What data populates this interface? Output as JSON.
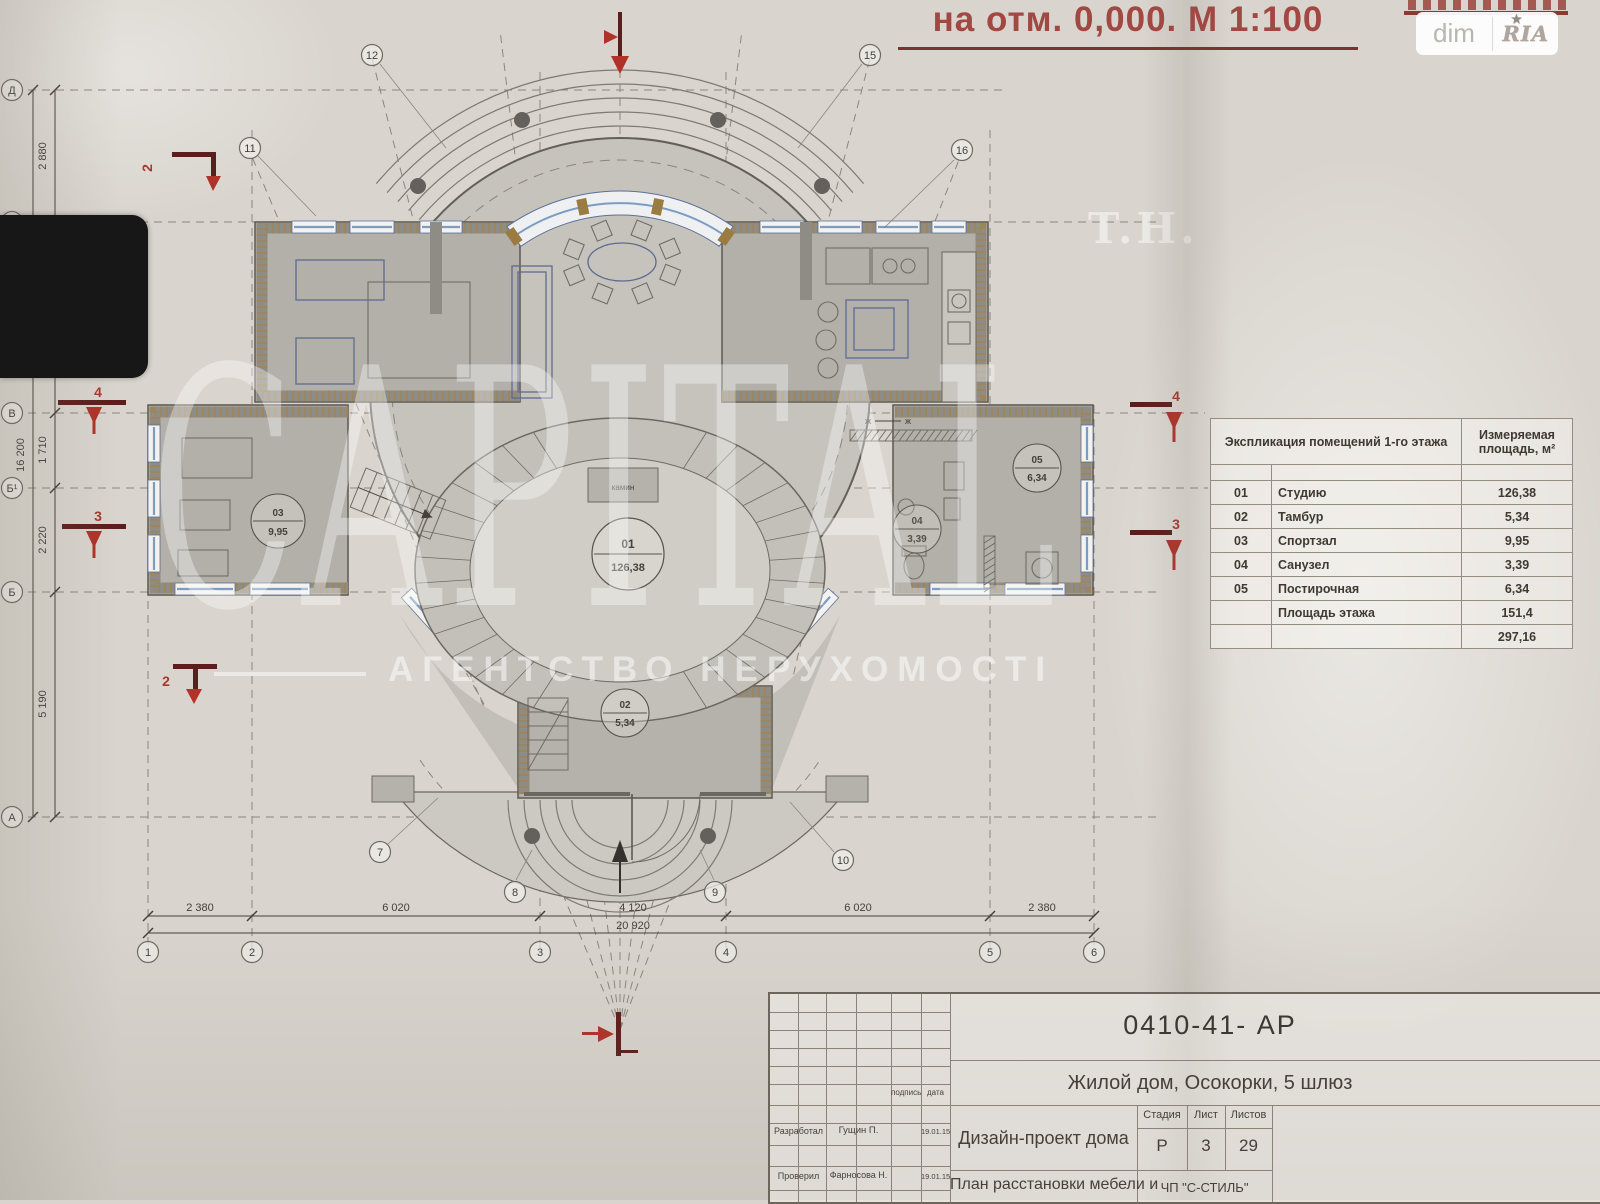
{
  "header": {
    "title": "на отм. 0,000. М 1:100",
    "logo_left": "dim",
    "logo_right": "RIA",
    "logo_star": "★"
  },
  "watermark": {
    "prefix": "T.H.",
    "brand": "CAPITAL",
    "subtitle": "АГЕНТСТВО НЕРУХОМОСТІ"
  },
  "explication": {
    "header_name": "Экспликация помещений 1-го этажа",
    "header_area": "Измеряемая площадь, м²",
    "rows": [
      {
        "num": "01",
        "name": "Студию",
        "area": "126,38"
      },
      {
        "num": "02",
        "name": "Тамбур",
        "area": "5,34"
      },
      {
        "num": "03",
        "name": "Спортзал",
        "area": "9,95"
      },
      {
        "num": "04",
        "name": "Санузел",
        "area": "3,39"
      },
      {
        "num": "05",
        "name": "Постирочная",
        "area": "6,34"
      }
    ],
    "total_label": "Площадь этажа",
    "total": "151,4",
    "grand_total": "297,16"
  },
  "titleblock": {
    "doc_number": "0410-41-  АР",
    "project": "Жилой дом, Осокорки, 5 шлюз",
    "design": "Дизайн-проект дома",
    "sheet_title": "План расстановки мебели и",
    "firm": "ЧП \"С-СТИЛЬ\"",
    "stage_label": "Стадия",
    "sheet_label": "Лист",
    "sheets_label": "Листов",
    "stage": "Р",
    "sheet": "3",
    "sheets": "29",
    "sign_label": "подпись",
    "date_label": "дата",
    "developed_label": "Разработал",
    "developed_by": "Гущин П.",
    "developed_date": "19.01.15",
    "checked_label": "Проверил",
    "checked_by": "Фарносова Н.",
    "checked_date": "19.01.15"
  },
  "rooms": [
    {
      "num": "01",
      "area": "126,38"
    },
    {
      "num": "02",
      "area": "5,34"
    },
    {
      "num": "03",
      "area": "9,95"
    },
    {
      "num": "04",
      "area": "3,39"
    },
    {
      "num": "05",
      "area": "6,34"
    }
  ],
  "plan_labels": {
    "fireplace": "камин",
    "axis_mark": "ж"
  },
  "marks": {
    "s2": "2",
    "s3": "3",
    "s4": "4"
  },
  "grid": {
    "cols": [
      "1",
      "2",
      "3",
      "4",
      "5",
      "6"
    ],
    "radials": [
      "7",
      "8",
      "9",
      "10",
      "11",
      "12",
      "15",
      "16"
    ],
    "rows": [
      "Д",
      "Г",
      "В",
      "Б¹",
      "Б",
      "А"
    ]
  },
  "dimensions": {
    "bottom": [
      "2 380",
      "6 020",
      "4 120",
      "6 020",
      "2 380"
    ],
    "bottom_total": "20 920",
    "left": [
      "2 880",
      "4 190",
      "1 710",
      "2 220",
      "5 190"
    ],
    "left_total": "16 200"
  }
}
